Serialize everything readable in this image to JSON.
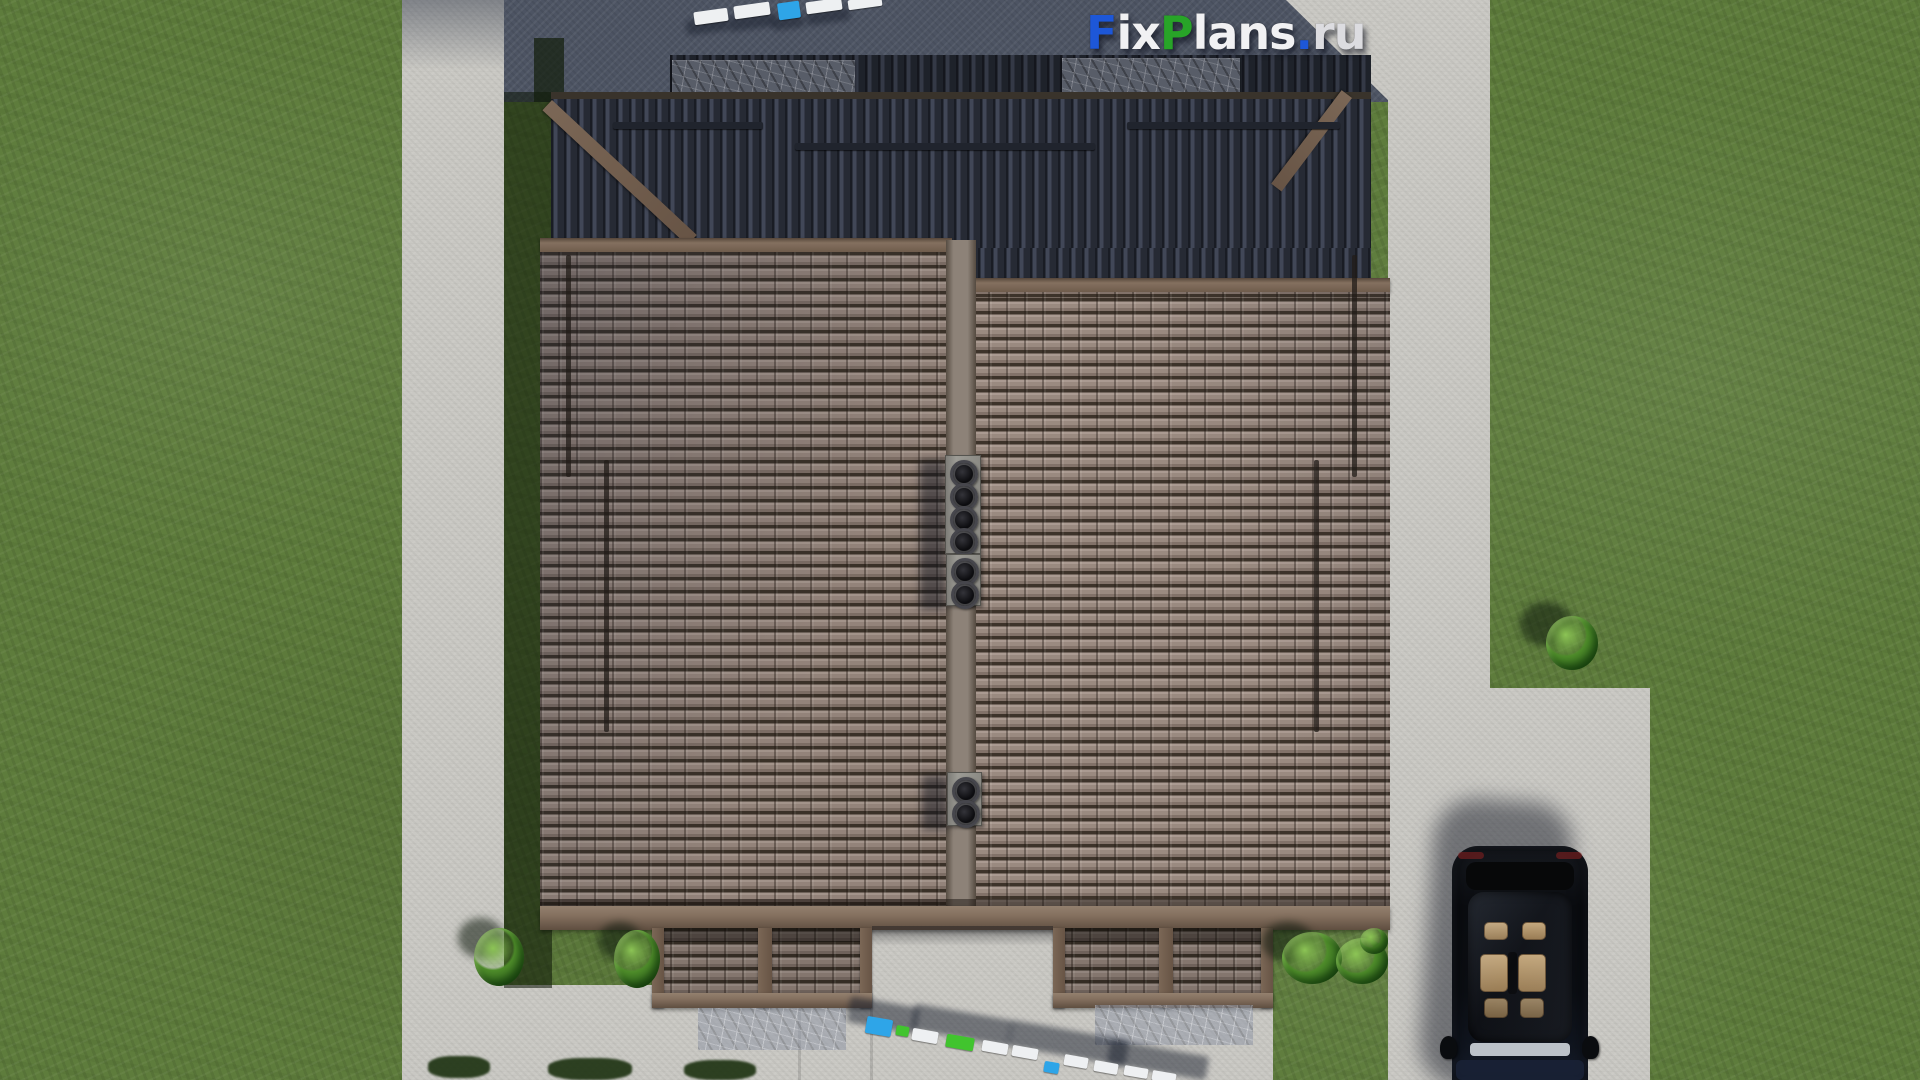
{
  "watermark": {
    "full_text": "FixPlans.ru",
    "parts": [
      {
        "text": "F"
      },
      {
        "text": "ix"
      },
      {
        "text": "P"
      },
      {
        "text": "lans"
      },
      {
        "text": "."
      },
      {
        "text": "ru"
      }
    ]
  },
  "house": {
    "chimney_vent_counts": [
      4,
      2,
      2
    ],
    "porch_count": 2
  },
  "palette": {
    "grass": "#5e7c3c",
    "concrete": "#c9c8c3",
    "concrete_shadow": "#4d5463",
    "tile": "#93837a",
    "tile_gap": "#3a3128",
    "roof_dark": "#2d313c",
    "ridge_brown": "#7a6757",
    "fascia_brown": "#84705f",
    "beam_brown": "#6f5b4b",
    "chimney_gray": "#96948e",
    "car_black": "#0c0e12",
    "seat_beige": "#c4a87e",
    "logo_blue": "#1d57d8",
    "logo_green": "#28a428",
    "logo_white": "#f1f1f3",
    "logo_gray": "#dcdce0",
    "obj_blue": "#2ea5e8",
    "obj_green": "#41c42e",
    "obj_white": "#eef0f2",
    "bush_green": "#4e8c2a"
  }
}
